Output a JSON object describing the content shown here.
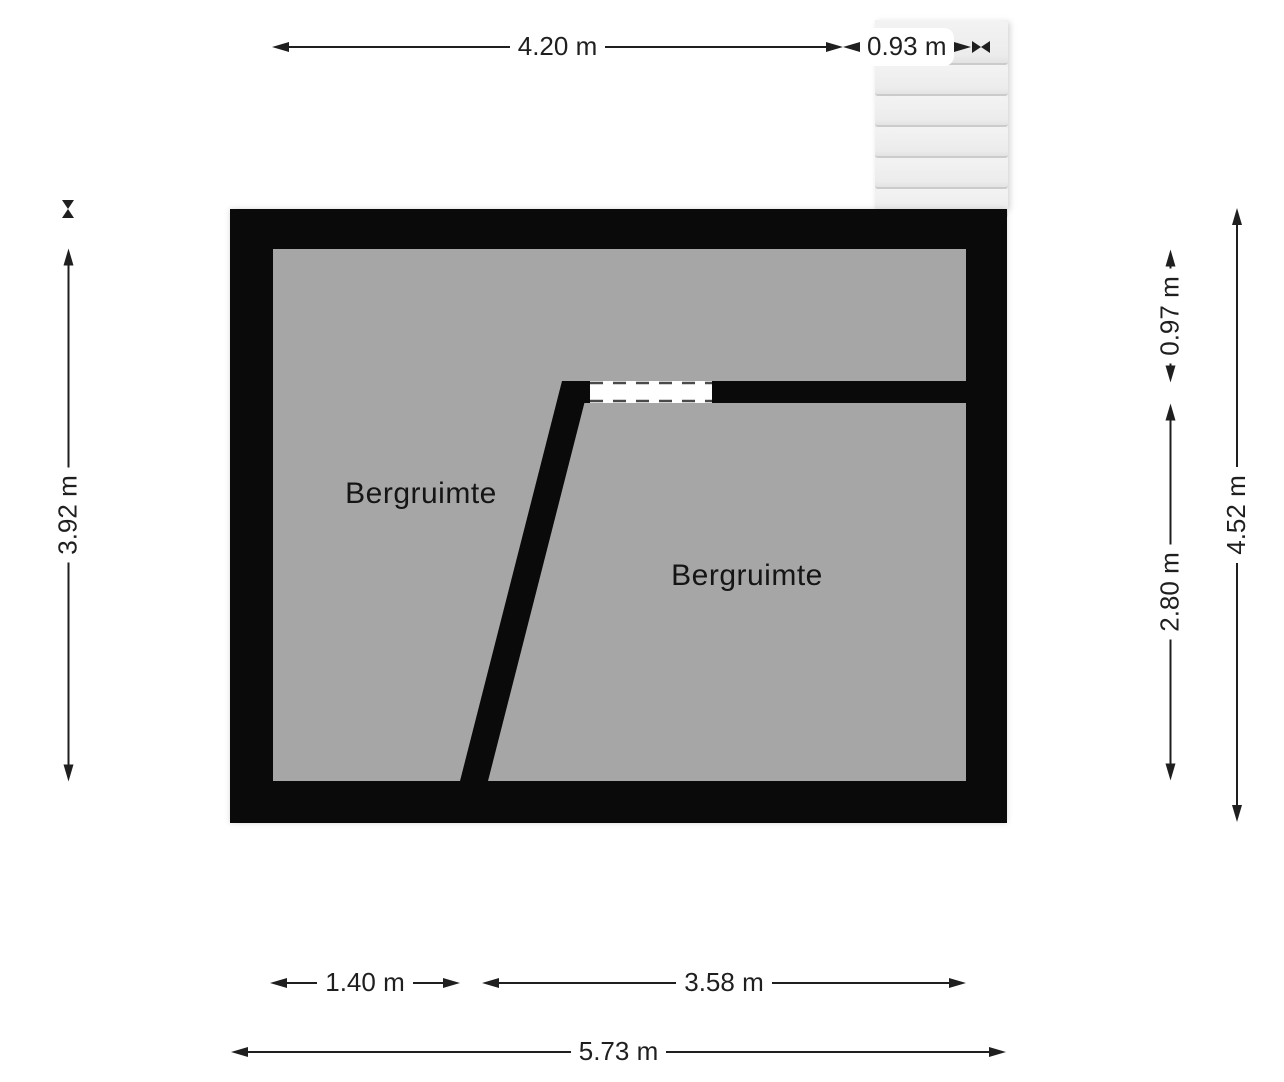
{
  "colors": {
    "wall": "#0a0a0a",
    "floor": "#a6a6a6",
    "dim": "#1f1f1f",
    "stair_fill": "#efefef",
    "stair_edge": "#cbcbcb",
    "window_fill": "#ffffff",
    "background": "#ffffff"
  },
  "rooms": {
    "left_label": "Bergruimte",
    "right_label": "Bergruimte"
  },
  "dims": {
    "top_main": "4.20 m",
    "top_stairs": "0.93 m",
    "left_inner_height": "3.92 m",
    "right_upper": "0.97 m",
    "right_lower": "2.80 m",
    "right_total": "4.52 m",
    "bottom_left": "1.40 m",
    "bottom_right": "3.58 m",
    "bottom_total": "5.73 m"
  },
  "stairs": {
    "step_count": 6
  }
}
